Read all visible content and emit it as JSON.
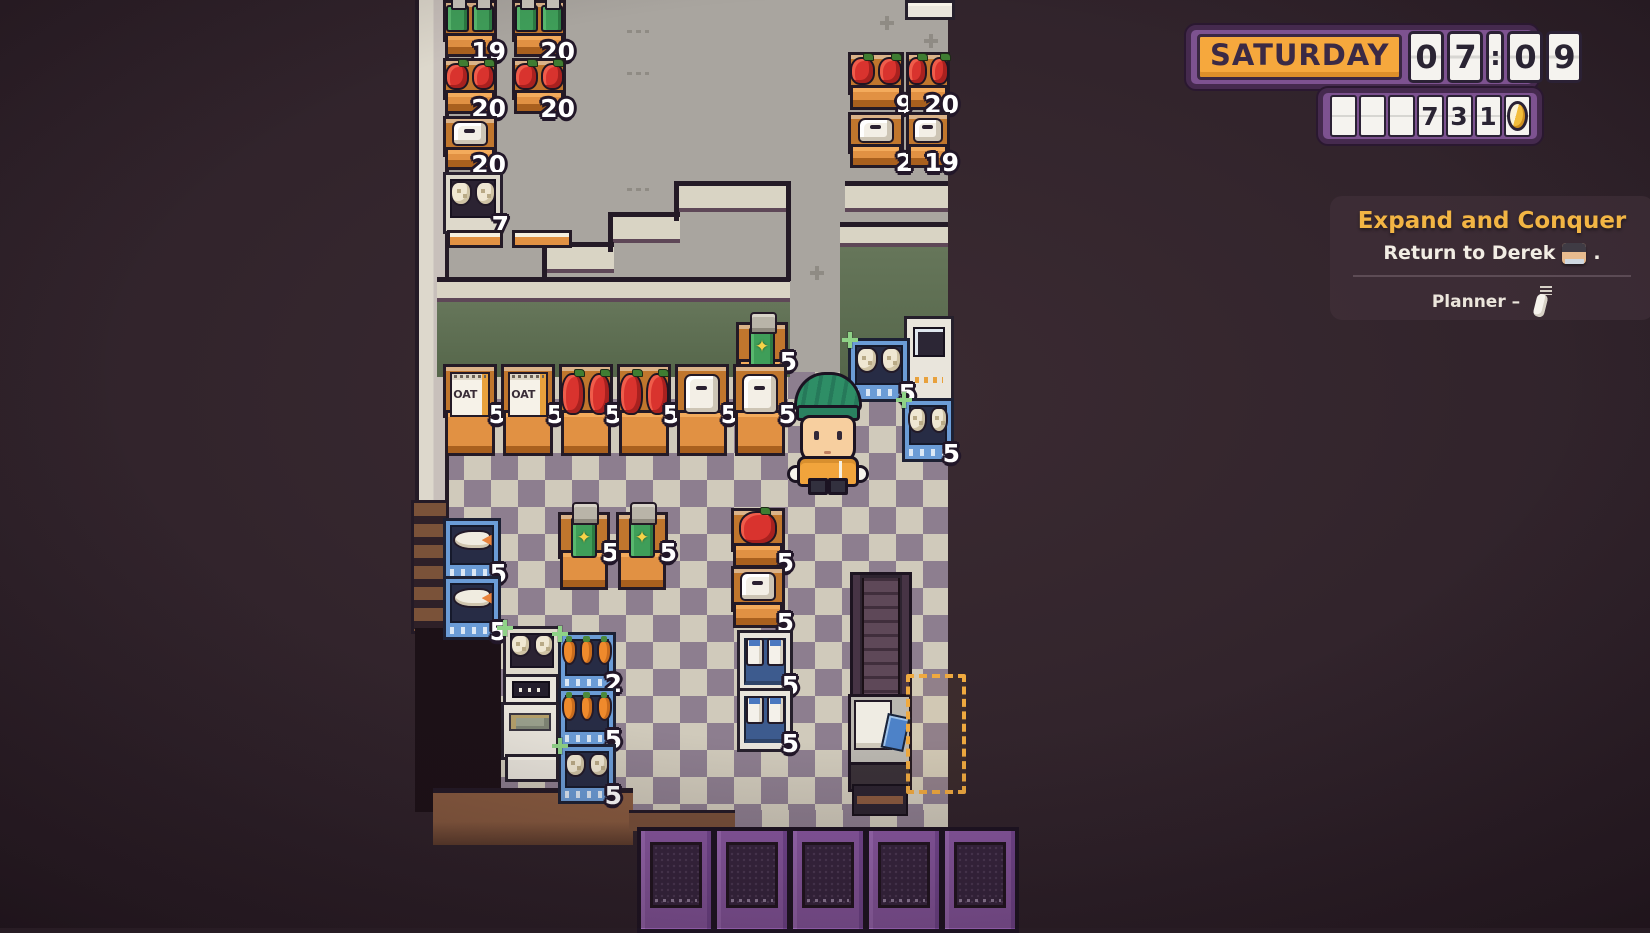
{
  "hud": {
    "day": "SATURDAY",
    "time_cells": [
      "0",
      "7",
      ":",
      "0",
      "9"
    ],
    "money_cells": [
      "",
      "",
      "",
      "7",
      "3",
      "1",
      "coin"
    ]
  },
  "quest": {
    "title": "Expand and Conquer",
    "objective_before": "Return to Derek",
    "objective_after": ".",
    "planner_label": "Planner –"
  },
  "labels": {
    "oat": "OAT"
  },
  "colors": {
    "accent_orange": "#f6a83d",
    "quest_gold": "#f2b544",
    "hud_purple": "#7d5290",
    "coin_gold": "#f3bd3c",
    "count_text": "#ffffff",
    "sparkle_green": "#8fd287",
    "marker_dash": "#efa93f",
    "floor_light": "#d0cabb",
    "floor_dark": "#8d7e8f",
    "wall_green": "#5d6b50"
  },
  "map": {
    "player": {
      "x": 793,
      "y": 372
    },
    "shelves": [
      {
        "item": "soda-green",
        "count": "19",
        "x": 443,
        "y": 0,
        "w": 54,
        "h": 57,
        "frame": "orange"
      },
      {
        "item": "soda-green",
        "count": "20",
        "x": 512,
        "y": 0,
        "w": 54,
        "h": 57,
        "frame": "orange"
      },
      {
        "item": "apple",
        "count": "20",
        "x": 443,
        "y": 58,
        "w": 54,
        "h": 56,
        "frame": "orange"
      },
      {
        "item": "apple",
        "count": "20",
        "x": 512,
        "y": 58,
        "w": 54,
        "h": 56,
        "frame": "orange"
      },
      {
        "item": "paper",
        "count": "20",
        "x": 443,
        "y": 116,
        "w": 54,
        "h": 54,
        "frame": "orange"
      },
      {
        "item": "chicken",
        "count": "7",
        "x": 443,
        "y": 172,
        "w": 54,
        "h": 56,
        "frame": "white"
      },
      {
        "item": "edge",
        "x": 447,
        "y": 230,
        "w": 50,
        "h": 12,
        "frame": "edge"
      },
      {
        "item": "edge",
        "x": 512,
        "y": 230,
        "w": 54,
        "h": 12,
        "frame": "edge"
      },
      {
        "item": "white-block",
        "x": 905,
        "y": 0,
        "w": 44,
        "h": 14,
        "frame": "plain"
      },
      {
        "item": "apple",
        "count": "9",
        "x": 848,
        "y": 52,
        "w": 56,
        "h": 58,
        "frame": "orange"
      },
      {
        "item": "apple",
        "count": "20",
        "x": 906,
        "y": 52,
        "w": 44,
        "h": 58,
        "frame": "orange"
      },
      {
        "item": "paper",
        "count": "2",
        "x": 848,
        "y": 112,
        "w": 56,
        "h": 56,
        "frame": "orange"
      },
      {
        "item": "paper",
        "count": "19",
        "x": 906,
        "y": 112,
        "w": 44,
        "h": 56,
        "frame": "orange"
      },
      {
        "item": "machine",
        "x": 904,
        "y": 316,
        "w": 44,
        "h": 80,
        "frame": "machine"
      },
      {
        "item": "soda-star",
        "count": "5",
        "x": 736,
        "y": 322,
        "w": 52,
        "h": 76,
        "frame": "orange",
        "top_jar": true
      },
      {
        "item": "chicken",
        "count": "5",
        "x": 848,
        "y": 338,
        "w": 56,
        "h": 58,
        "frame": "blue",
        "sparkle": true
      },
      {
        "item": "oat",
        "count": "5",
        "x": 443,
        "y": 364,
        "w": 54,
        "h": 92,
        "frame": "orange"
      },
      {
        "item": "oat",
        "count": "5",
        "x": 501,
        "y": 364,
        "w": 54,
        "h": 92,
        "frame": "orange"
      },
      {
        "item": "apple",
        "count": "5",
        "x": 559,
        "y": 364,
        "w": 54,
        "h": 92,
        "frame": "orange"
      },
      {
        "item": "apple",
        "count": "5",
        "x": 617,
        "y": 364,
        "w": 54,
        "h": 92,
        "frame": "orange"
      },
      {
        "item": "paper",
        "count": "5",
        "x": 675,
        "y": 364,
        "w": 54,
        "h": 92,
        "frame": "orange"
      },
      {
        "item": "paper",
        "count": "5",
        "x": 733,
        "y": 364,
        "w": 54,
        "h": 92,
        "frame": "orange"
      },
      {
        "item": "chicken",
        "count": "5",
        "x": 902,
        "y": 398,
        "w": 46,
        "h": 58,
        "frame": "blue",
        "sparkle": true
      },
      {
        "item": "apple",
        "count": "5",
        "x": 731,
        "y": 508,
        "w": 54,
        "h": 60,
        "frame": "orange",
        "big": true
      },
      {
        "item": "soda-star",
        "count": "5",
        "x": 558,
        "y": 512,
        "w": 52,
        "h": 78,
        "frame": "orange",
        "top_jar": true
      },
      {
        "item": "soda-star",
        "count": "5",
        "x": 616,
        "y": 512,
        "w": 52,
        "h": 78,
        "frame": "orange",
        "top_jar": true
      },
      {
        "item": "fish",
        "count": "5",
        "x": 443,
        "y": 518,
        "w": 52,
        "h": 58,
        "frame": "blue"
      },
      {
        "item": "paper",
        "count": "5",
        "x": 731,
        "y": 566,
        "w": 54,
        "h": 62,
        "frame": "orange"
      },
      {
        "item": "fish",
        "count": "5",
        "x": 443,
        "y": 576,
        "w": 52,
        "h": 58,
        "frame": "blue"
      },
      {
        "item": "chicken",
        "x": 503,
        "y": 626,
        "w": 52,
        "h": 50,
        "frame": "white",
        "sparkle": true
      },
      {
        "item": "milk",
        "count": "5",
        "x": 737,
        "y": 630,
        "w": 50,
        "h": 58,
        "frame": "fridge"
      },
      {
        "item": "carrot",
        "count": "2",
        "x": 558,
        "y": 632,
        "w": 52,
        "h": 54,
        "frame": "blue",
        "sparkle": true
      },
      {
        "item": "register",
        "x": 503,
        "y": 674,
        "w": 50,
        "h": 30,
        "frame": "machine"
      },
      {
        "item": "carrot",
        "count": "5",
        "x": 558,
        "y": 688,
        "w": 52,
        "h": 54,
        "frame": "blue"
      },
      {
        "item": "milk",
        "count": "5",
        "x": 737,
        "y": 688,
        "w": 50,
        "h": 58,
        "frame": "fridge"
      },
      {
        "item": "gray-unit",
        "x": 501,
        "y": 702,
        "w": 52,
        "h": 52,
        "frame": "machine"
      },
      {
        "item": "chicken",
        "count": "5",
        "x": 558,
        "y": 744,
        "w": 52,
        "h": 54,
        "frame": "blue",
        "sparkle": true
      },
      {
        "item": "white-block",
        "x": 505,
        "y": 754,
        "w": 48,
        "h": 22,
        "frame": "plain"
      }
    ],
    "walls": [
      {
        "x": 676,
        "y": 181,
        "w": 114,
        "beige": 22,
        "green": 0
      },
      {
        "x": 610,
        "y": 212,
        "w": 70,
        "beige": 22,
        "green": 0
      },
      {
        "x": 544,
        "y": 242,
        "w": 70,
        "beige": 22,
        "green": 0
      },
      {
        "x": 845,
        "y": 181,
        "w": 103,
        "beige": 22,
        "green": 0
      },
      {
        "x": 840,
        "y": 222,
        "w": 108,
        "beige": 16,
        "green": 131
      },
      {
        "x": 437,
        "y": 277,
        "w": 353,
        "beige": 16,
        "green": 75
      }
    ],
    "wall_lines": [
      {
        "x": 674,
        "y": 181,
        "w": 5,
        "h": 40
      },
      {
        "x": 608,
        "y": 212,
        "w": 5,
        "h": 40
      },
      {
        "x": 542,
        "y": 242,
        "w": 5,
        "h": 40
      },
      {
        "x": 786,
        "y": 181,
        "w": 5,
        "h": 100
      }
    ],
    "floor_marks": [
      {
        "t": "plus",
        "x": 880,
        "y": 16
      },
      {
        "t": "plus",
        "x": 924,
        "y": 34
      },
      {
        "t": "plus",
        "x": 810,
        "y": 266
      },
      {
        "t": "speck",
        "x": 627,
        "y": 30
      },
      {
        "t": "speck",
        "x": 627,
        "y": 72
      },
      {
        "t": "speck",
        "x": 627,
        "y": 188
      }
    ],
    "doors": {
      "y": 827,
      "w": 70,
      "h": 98,
      "xs": [
        637,
        713,
        789,
        865,
        941
      ]
    },
    "checkout": {
      "conveyor": {
        "x": 850,
        "y": 572,
        "w": 56,
        "h": 124
      },
      "register": {
        "x": 848,
        "y": 694,
        "w": 58,
        "h": 92
      },
      "base": {
        "x": 852,
        "y": 784,
        "w": 52,
        "h": 28
      },
      "marker": {
        "x": 906,
        "y": 674,
        "w": 52,
        "h": 112
      }
    }
  }
}
